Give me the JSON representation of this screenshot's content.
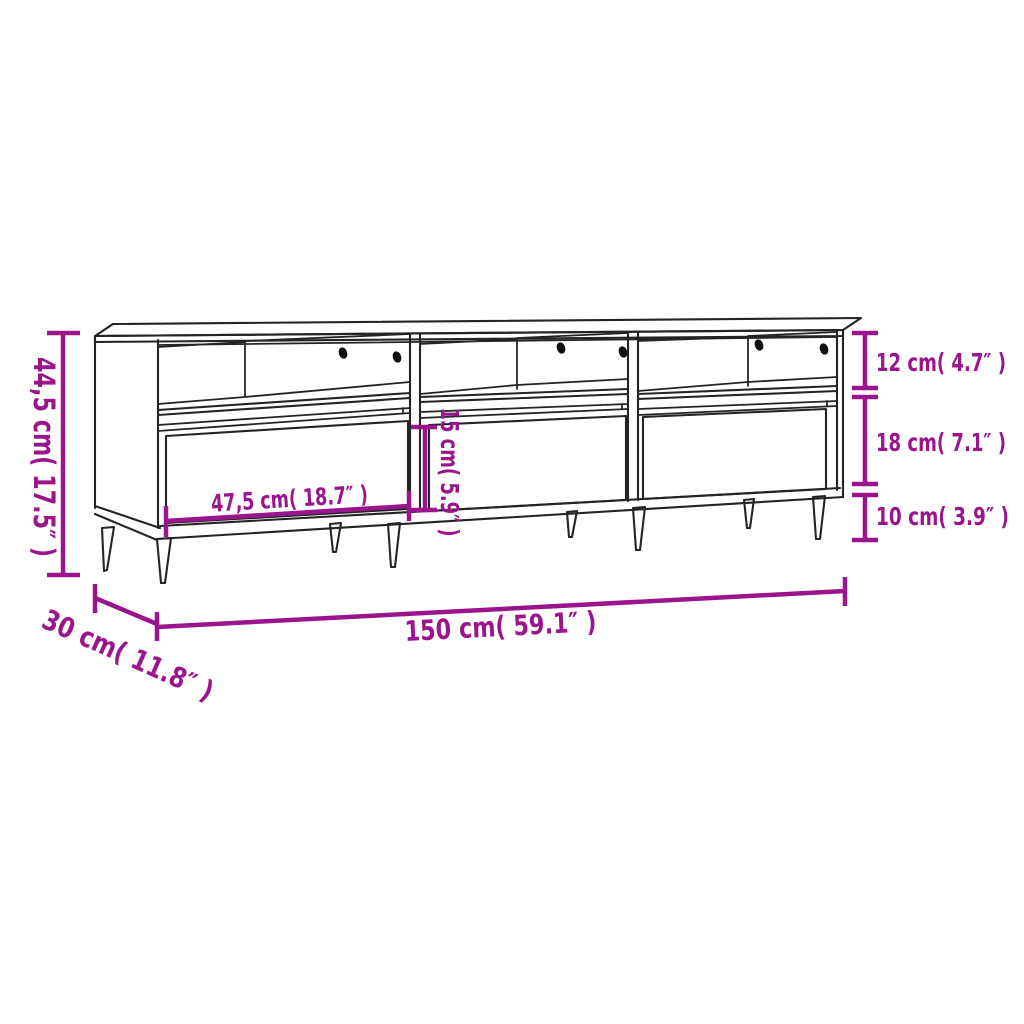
{
  "canvas": {
    "width": 1024,
    "height": 1024,
    "background_color": "#ffffff"
  },
  "colors": {
    "dimension_accent": "#9A148C",
    "drawing_lines": "#242424",
    "cable_holes": "#111111"
  },
  "drawing": {
    "subject": "TV stand / media cabinet line drawing",
    "sections": 3,
    "open_compartments": 3,
    "drawers": 3,
    "legs": 8,
    "cable_holes_per_compartment": 2
  },
  "dimensions": {
    "overall_height": {
      "cm": "44,5",
      "inches": "17.5",
      "label": "44,5 cm( 17.5″ )"
    },
    "top_compartment_height": {
      "cm": "12",
      "inches": "4.7",
      "label": "12 cm( 4.7″ )"
    },
    "drawer_section_height": {
      "cm": "18",
      "inches": "7.1",
      "label": "18 cm( 7.1″ )"
    },
    "leg_height": {
      "cm": "10",
      "inches": "3.9",
      "label": "10 cm( 3.9″ )"
    },
    "drawer_width": {
      "cm": "47,5",
      "inches": "18.7",
      "label": "47,5 cm( 18.7″ )"
    },
    "drawer_front_height": {
      "cm": "15",
      "inches": "5.9",
      "label": "15 cm( 5.9″ )"
    },
    "overall_width": {
      "cm": "150",
      "inches": "59.1",
      "label": "150 cm( 59.1″ )"
    },
    "overall_depth": {
      "cm": "30",
      "inches": "11.8",
      "label": "30 cm( 11.8″ )"
    }
  }
}
